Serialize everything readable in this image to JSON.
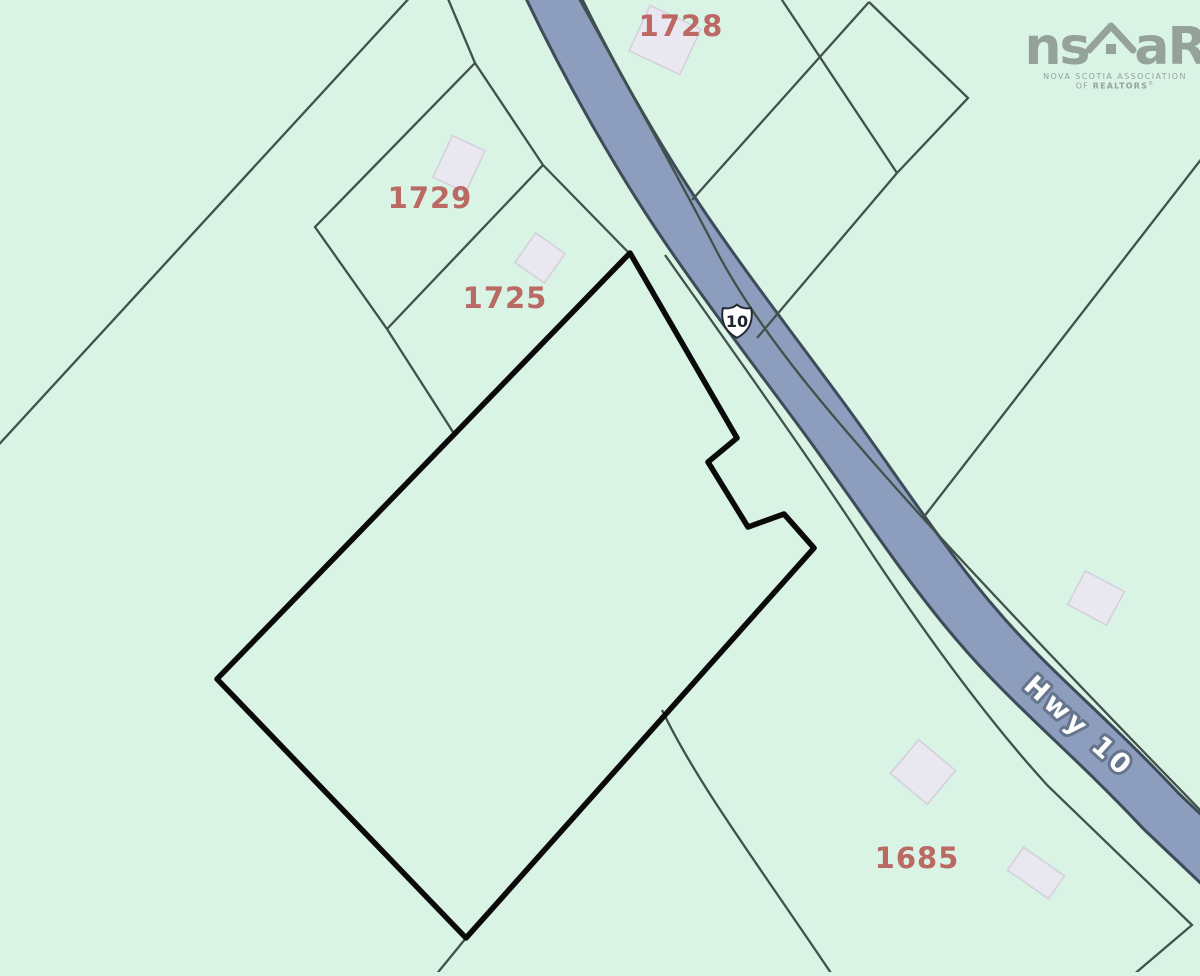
{
  "parcels": [
    {
      "label": "1728"
    },
    {
      "label": "1729"
    },
    {
      "label": "1725"
    },
    {
      "label": "1685"
    }
  ],
  "road": {
    "shield_number": "10",
    "name": "Hwy 10"
  },
  "logo": {
    "left_text": "ns",
    "right_text": "aR",
    "tagline_line1": "NOVA SCOTIA ASSOCIATION",
    "tagline_line2_prefix": "OF ",
    "tagline_line2_name": "REALTORS",
    "registered_mark": "®"
  },
  "colors": {
    "background": "#d9f3e5",
    "road_fill": "#8c9dbd",
    "road_casing": "#3e4b58",
    "boundary_line": "#41524a",
    "subject_outline": "#0a0a0a",
    "building_fill": "#e9e7ef",
    "building_stroke": "#d3d0db",
    "parcel_label": "#b5524d",
    "logo_gray": "#94a29b"
  }
}
